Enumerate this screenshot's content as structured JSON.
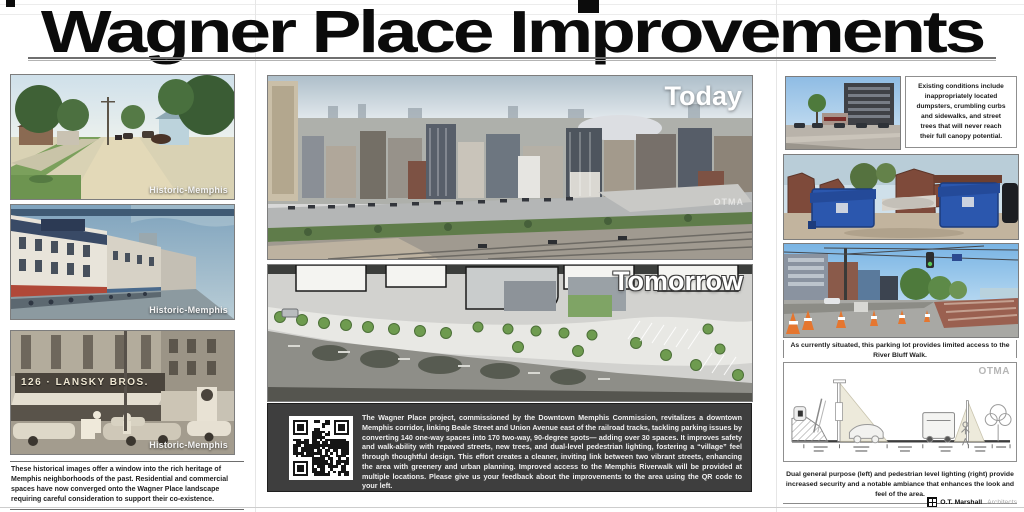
{
  "title": "Wagner Place Improvements",
  "left_column": {
    "photos": [
      {
        "label": "Historic-Memphis"
      },
      {
        "label": "Historic-Memphis"
      },
      {
        "label": "Historic-Memphis",
        "sign_text": "126 · LANSKY BROS."
      }
    ],
    "caption": "These historical images offer a window into the rich heritage of Memphis neighborhoods of the past. Residential and commercial spaces have now converged onto the Wagner Place landscape requiring careful consideration to support their co-existence."
  },
  "center": {
    "today_label": "Today",
    "today_watermark": "OTMA",
    "tomorrow_label": "Tomorrow",
    "description": "The Wagner Place project, commissioned by the Downtown Memphis Commission, revitalizes a downtown Memphis corridor, linking Beale Street and Union Avenue east of the railroad tracks, tackling parking issues by converting 140 one-way spaces into 170 two-way, 90-degree spots— adding over 30 spaces. It improves safety and walk-ability with repaved streets, new trees, and dual-level pedestrian lighting, fostering a “village” feel through thoughtful design. This effort creates a cleaner, inviting link between two vibrant streets, enhancing the area with greenery and urban planning. Improved access to the Memphis Riverwalk will be provided at multiple locations. Please give us your feedback about the improvements to the area using the QR code to your left."
  },
  "right_column": {
    "existing_conditions": "Existing conditions include inappropriately located dumpsters, crumbling curbs and sidewalks, and street trees that will never reach their full canopy potential.",
    "parking_caption": "As currently situated, this parking lot provides limited access to the River Bluff Walk.",
    "diagram_watermark": "OTMA",
    "lighting_caption": "Dual general purpose (left) and pedestrian level lighting (right) provide increased security and a notable ambiance that enhances the look and feel of the area."
  },
  "footer": {
    "firm_name": "O.T. Marshall",
    "firm_suffix": "Architects"
  },
  "colors": {
    "panel_dark": "#3e3e3e",
    "dumpster_blue": "#2b57ae",
    "brick_red": "#7e4a3a",
    "cone_orange": "#e5762f",
    "tree_green": "#6e9b4f"
  }
}
